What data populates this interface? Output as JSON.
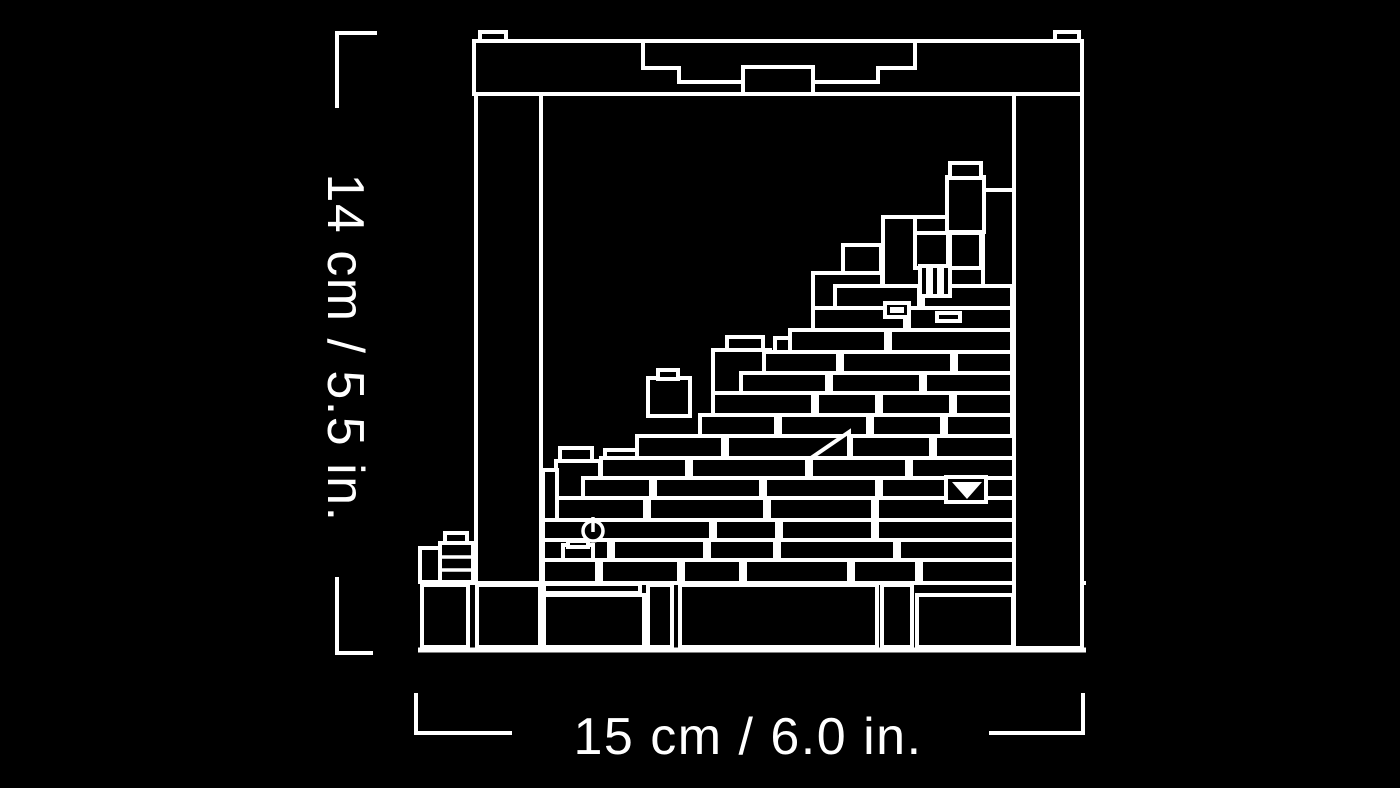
{
  "canvas": {
    "background_color": "#000000",
    "line_color": "#ffffff"
  },
  "dimension_labels": {
    "height": "14 cm / 5.5 in.",
    "width": "15 cm / 6.0 in."
  }
}
